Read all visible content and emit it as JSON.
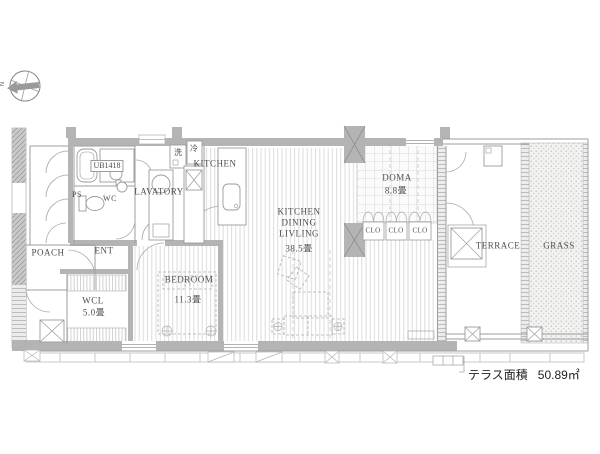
{
  "title": "apartment-floor-plan",
  "compass": {
    "north": "N"
  },
  "rooms": {
    "ps": "PS",
    "poach": "POACH",
    "ent": "ENT",
    "ub": "UB1418",
    "wc": "WC",
    "lavatory": "LAVATORY",
    "washer": "洗",
    "fridge": "冷",
    "kitchen": "KITCHEN",
    "wcl": {
      "name": "WCL",
      "size": "5.0畳"
    },
    "bedroom": {
      "name": "BEDROOM",
      "size": "11.3畳"
    },
    "kdl": {
      "line1": "KITCHEN",
      "line2": "DINING",
      "line3": "LIVLING",
      "size": "38.5畳"
    },
    "doma": {
      "name": "DOMA",
      "size": "8.8畳"
    },
    "closets": [
      "CLO",
      "CLO",
      "CLO"
    ],
    "terrace": "TERRACE",
    "grass": "GRASS"
  },
  "annotation": {
    "label": "テラス面積",
    "value": "50.89㎡"
  },
  "palette": {
    "wall_gray": "#b4b4b4",
    "line_gray": "#9b9b9b",
    "floor_line": "#dcdcdc",
    "text_gray": "#4e4e4e"
  }
}
